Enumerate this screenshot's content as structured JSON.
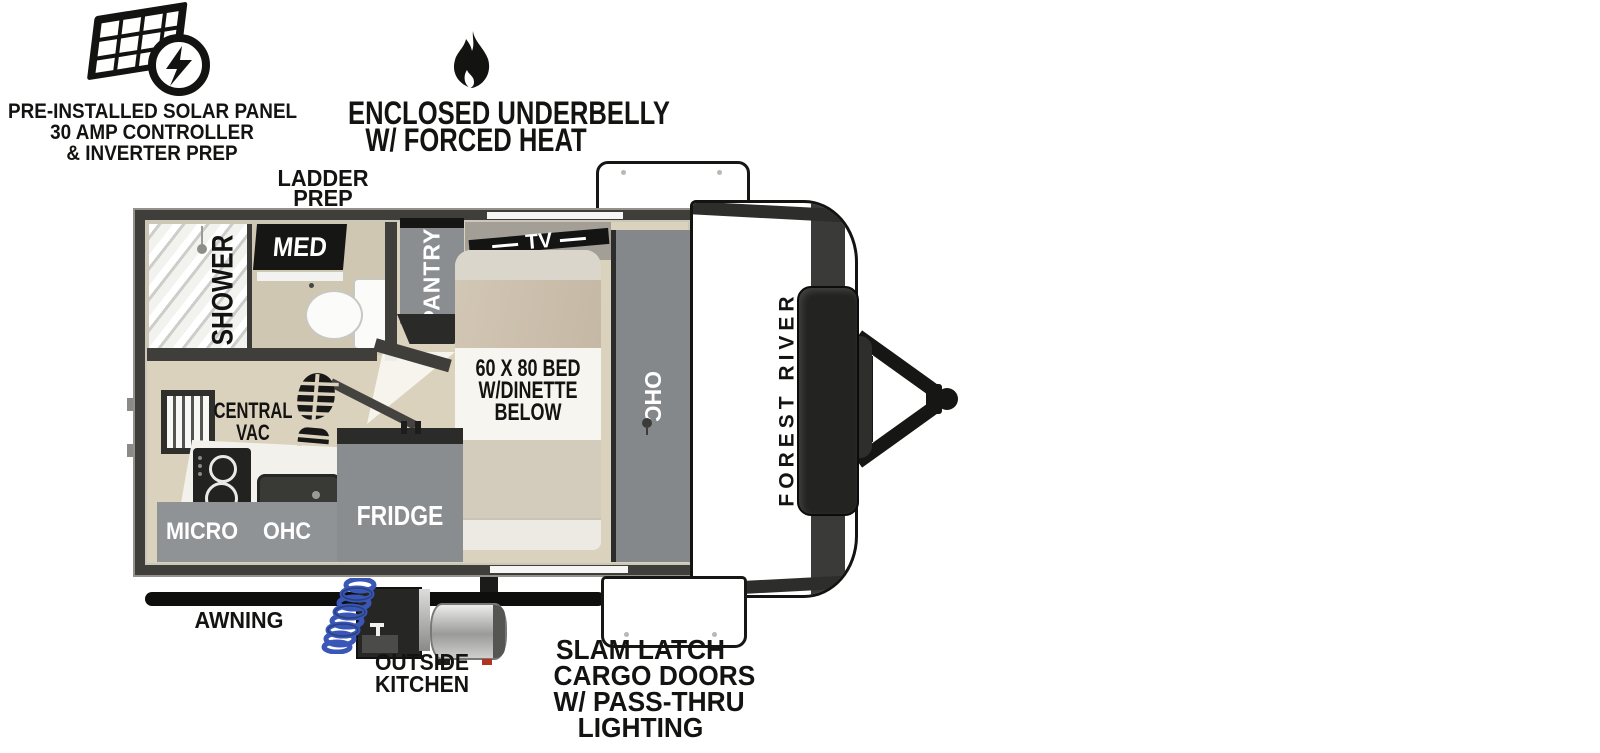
{
  "callouts": {
    "solar": {
      "icon": "solar-panel-icon",
      "lines": [
        "PRE-INSTALLED SOLAR PANEL",
        "30 AMP CONTROLLER",
        "& INVERTER PREP"
      ]
    },
    "underbelly": {
      "icon": "flame-icon",
      "lines": [
        "ENCLOSED UNDERBELLY",
        "W/ FORCED HEAT"
      ]
    },
    "ladder_prep": {
      "lines": [
        "LADDER",
        "PREP"
      ]
    },
    "awning": {
      "label": "AWNING"
    },
    "outside_kitchen": {
      "lines": [
        "OUTSIDE",
        "KITCHEN"
      ]
    },
    "cargo_doors": {
      "lines": [
        "SLAM LATCH",
        "CARGO DOORS",
        "W/ PASS-THRU",
        "LIGHTING"
      ]
    }
  },
  "floorplan": {
    "labels": {
      "shower": "SHOWER",
      "med_cabinet": "MED",
      "pantry": "PANTRY",
      "tv": "TV",
      "bed_lines": [
        "60 X 80 BED",
        "W/DINETTE",
        "BELOW"
      ],
      "overhead_cabinet_bedside": "OHC",
      "central_vac_lines": [
        "CENTRAL",
        "VAC"
      ],
      "fridge": "FRIDGE",
      "microwave": "MICRO",
      "overhead_cabinet_kitchen": "OHC"
    }
  },
  "exterior": {
    "brand": "FOREST RIVER"
  },
  "colors": {
    "wall": "#3f3e3b",
    "floor": "#dbd2bd",
    "bath_floor": "#d0c7b2",
    "cabinet_gray": "#8a8d90",
    "bed_base": "#dbd4c6",
    "bed_blanket": "#cbbfac",
    "label_patch": "#f7f5ef",
    "ink": "#131312",
    "hose_blue": "#3a57b8",
    "accent_red": "#b23420"
  },
  "icons": [
    "solar-panel-icon",
    "lightning-bolt-icon",
    "flame-icon",
    "boot-print-icon",
    "window-icon",
    "shower-head-icon",
    "awning-bar",
    "cargo-door",
    "a-frame-hitch",
    "propane-cover",
    "tongue-jack",
    "outside-kitchen-unit",
    "water-hose-coil",
    "griddle-tank"
  ]
}
